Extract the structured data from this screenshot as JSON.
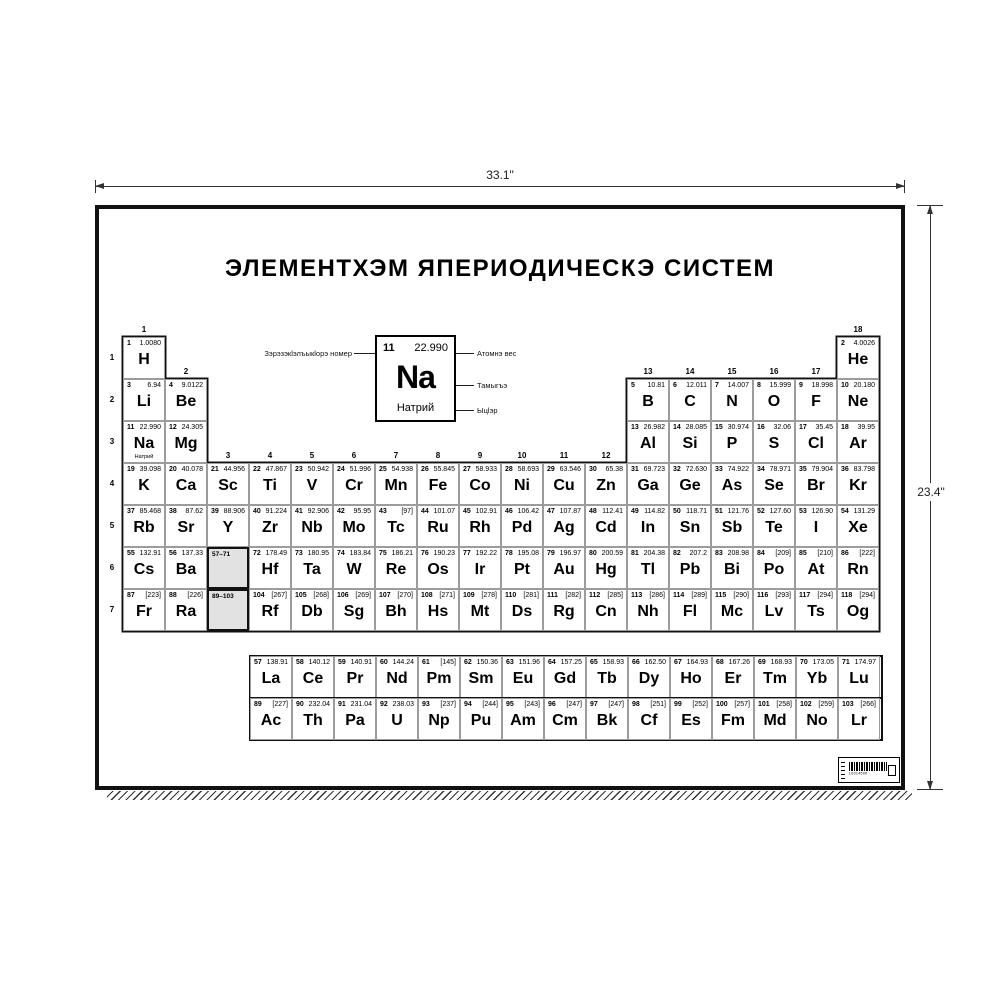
{
  "dimensions": {
    "width_label": "33.1\"",
    "height_label": "23.4\""
  },
  "poster": {
    "title": "ЭЛЕМЕНТХЭМ ЯПЕРИОДИЧЕСКЭ СИСТЕМ",
    "colors": {
      "ink": "#000000",
      "paper": "#ffffff",
      "placeholder_gray": "#e2e2e2",
      "grid_line": "#9c9c9c"
    }
  },
  "legend": {
    "number": "11",
    "mass": "22.990",
    "symbol": "Na",
    "name": "Натрий",
    "label_number": "Зэрэзэкlэлъыкlорэ номер",
    "label_mass": "Атомнэ вес",
    "label_symbol": "Тамыгъэ",
    "label_name": "Ыцlэр"
  },
  "table": {
    "group_labels": [
      "1",
      "2",
      "3",
      "4",
      "5",
      "6",
      "7",
      "8",
      "9",
      "10",
      "11",
      "12",
      "13",
      "14",
      "15",
      "16",
      "17",
      "18"
    ],
    "period_labels": [
      "1",
      "2",
      "3",
      "4",
      "5",
      "6",
      "7"
    ],
    "placeholders": [
      {
        "label": "57–71",
        "p": 6,
        "g": 3
      },
      {
        "label": "89–103",
        "p": 7,
        "g": 3
      }
    ],
    "elements": [
      {
        "p": 1,
        "g": 1,
        "n": "1",
        "sym": "H",
        "mass": "1.0080"
      },
      {
        "p": 1,
        "g": 18,
        "n": "2",
        "sym": "He",
        "mass": "4.0026"
      },
      {
        "p": 2,
        "g": 1,
        "n": "3",
        "sym": "Li",
        "mass": "6.94"
      },
      {
        "p": 2,
        "g": 2,
        "n": "4",
        "sym": "Be",
        "mass": "9.0122"
      },
      {
        "p": 2,
        "g": 13,
        "n": "5",
        "sym": "B",
        "mass": "10.81"
      },
      {
        "p": 2,
        "g": 14,
        "n": "6",
        "sym": "C",
        "mass": "12.011"
      },
      {
        "p": 2,
        "g": 15,
        "n": "7",
        "sym": "N",
        "mass": "14.007"
      },
      {
        "p": 2,
        "g": 16,
        "n": "8",
        "sym": "O",
        "mass": "15.999"
      },
      {
        "p": 2,
        "g": 17,
        "n": "9",
        "sym": "F",
        "mass": "18.998"
      },
      {
        "p": 2,
        "g": 18,
        "n": "10",
        "sym": "Ne",
        "mass": "20.180"
      },
      {
        "p": 3,
        "g": 1,
        "n": "11",
        "sym": "Na",
        "mass": "22.990",
        "name": "Натрий"
      },
      {
        "p": 3,
        "g": 2,
        "n": "12",
        "sym": "Mg",
        "mass": "24.305"
      },
      {
        "p": 3,
        "g": 13,
        "n": "13",
        "sym": "Al",
        "mass": "26.982"
      },
      {
        "p": 3,
        "g": 14,
        "n": "14",
        "sym": "Si",
        "mass": "28.085"
      },
      {
        "p": 3,
        "g": 15,
        "n": "15",
        "sym": "P",
        "mass": "30.974"
      },
      {
        "p": 3,
        "g": 16,
        "n": "16",
        "sym": "S",
        "mass": "32.06"
      },
      {
        "p": 3,
        "g": 17,
        "n": "17",
        "sym": "Cl",
        "mass": "35.45"
      },
      {
        "p": 3,
        "g": 18,
        "n": "18",
        "sym": "Ar",
        "mass": "39.95"
      },
      {
        "p": 4,
        "g": 1,
        "n": "19",
        "sym": "K",
        "mass": "39.098"
      },
      {
        "p": 4,
        "g": 2,
        "n": "20",
        "sym": "Ca",
        "mass": "40.078"
      },
      {
        "p": 4,
        "g": 3,
        "n": "21",
        "sym": "Sc",
        "mass": "44.956"
      },
      {
        "p": 4,
        "g": 4,
        "n": "22",
        "sym": "Ti",
        "mass": "47.867"
      },
      {
        "p": 4,
        "g": 5,
        "n": "23",
        "sym": "V",
        "mass": "50.942"
      },
      {
        "p": 4,
        "g": 6,
        "n": "24",
        "sym": "Cr",
        "mass": "51.996"
      },
      {
        "p": 4,
        "g": 7,
        "n": "25",
        "sym": "Mn",
        "mass": "54.938"
      },
      {
        "p": 4,
        "g": 8,
        "n": "26",
        "sym": "Fe",
        "mass": "55.845"
      },
      {
        "p": 4,
        "g": 9,
        "n": "27",
        "sym": "Co",
        "mass": "58.933"
      },
      {
        "p": 4,
        "g": 10,
        "n": "28",
        "sym": "Ni",
        "mass": "58.693"
      },
      {
        "p": 4,
        "g": 11,
        "n": "29",
        "sym": "Cu",
        "mass": "63.546"
      },
      {
        "p": 4,
        "g": 12,
        "n": "30",
        "sym": "Zn",
        "mass": "65.38"
      },
      {
        "p": 4,
        "g": 13,
        "n": "31",
        "sym": "Ga",
        "mass": "69.723"
      },
      {
        "p": 4,
        "g": 14,
        "n": "32",
        "sym": "Ge",
        "mass": "72.630"
      },
      {
        "p": 4,
        "g": 15,
        "n": "33",
        "sym": "As",
        "mass": "74.922"
      },
      {
        "p": 4,
        "g": 16,
        "n": "34",
        "sym": "Se",
        "mass": "78.971"
      },
      {
        "p": 4,
        "g": 17,
        "n": "35",
        "sym": "Br",
        "mass": "79.904"
      },
      {
        "p": 4,
        "g": 18,
        "n": "36",
        "sym": "Kr",
        "mass": "83.798"
      },
      {
        "p": 5,
        "g": 1,
        "n": "37",
        "sym": "Rb",
        "mass": "85.468"
      },
      {
        "p": 5,
        "g": 2,
        "n": "38",
        "sym": "Sr",
        "mass": "87.62"
      },
      {
        "p": 5,
        "g": 3,
        "n": "39",
        "sym": "Y",
        "mass": "88.906"
      },
      {
        "p": 5,
        "g": 4,
        "n": "40",
        "sym": "Zr",
        "mass": "91.224"
      },
      {
        "p": 5,
        "g": 5,
        "n": "41",
        "sym": "Nb",
        "mass": "92.906"
      },
      {
        "p": 5,
        "g": 6,
        "n": "42",
        "sym": "Mo",
        "mass": "95.95"
      },
      {
        "p": 5,
        "g": 7,
        "n": "43",
        "sym": "Tc",
        "mass": "[97]"
      },
      {
        "p": 5,
        "g": 8,
        "n": "44",
        "sym": "Ru",
        "mass": "101.07"
      },
      {
        "p": 5,
        "g": 9,
        "n": "45",
        "sym": "Rh",
        "mass": "102.91"
      },
      {
        "p": 5,
        "g": 10,
        "n": "46",
        "sym": "Pd",
        "mass": "106.42"
      },
      {
        "p": 5,
        "g": 11,
        "n": "47",
        "sym": "Ag",
        "mass": "107.87"
      },
      {
        "p": 5,
        "g": 12,
        "n": "48",
        "sym": "Cd",
        "mass": "112.41"
      },
      {
        "p": 5,
        "g": 13,
        "n": "49",
        "sym": "In",
        "mass": "114.82"
      },
      {
        "p": 5,
        "g": 14,
        "n": "50",
        "sym": "Sn",
        "mass": "118.71"
      },
      {
        "p": 5,
        "g": 15,
        "n": "51",
        "sym": "Sb",
        "mass": "121.76"
      },
      {
        "p": 5,
        "g": 16,
        "n": "52",
        "sym": "Te",
        "mass": "127.60"
      },
      {
        "p": 5,
        "g": 17,
        "n": "53",
        "sym": "I",
        "mass": "126.90"
      },
      {
        "p": 5,
        "g": 18,
        "n": "54",
        "sym": "Xe",
        "mass": "131.29"
      },
      {
        "p": 6,
        "g": 1,
        "n": "55",
        "sym": "Cs",
        "mass": "132.91"
      },
      {
        "p": 6,
        "g": 2,
        "n": "56",
        "sym": "Ba",
        "mass": "137.33"
      },
      {
        "p": 6,
        "g": 4,
        "n": "72",
        "sym": "Hf",
        "mass": "178.49"
      },
      {
        "p": 6,
        "g": 5,
        "n": "73",
        "sym": "Ta",
        "mass": "180.95"
      },
      {
        "p": 6,
        "g": 6,
        "n": "74",
        "sym": "W",
        "mass": "183.84"
      },
      {
        "p": 6,
        "g": 7,
        "n": "75",
        "sym": "Re",
        "mass": "186.21"
      },
      {
        "p": 6,
        "g": 8,
        "n": "76",
        "sym": "Os",
        "mass": "190.23"
      },
      {
        "p": 6,
        "g": 9,
        "n": "77",
        "sym": "Ir",
        "mass": "192.22"
      },
      {
        "p": 6,
        "g": 10,
        "n": "78",
        "sym": "Pt",
        "mass": "195.08"
      },
      {
        "p": 6,
        "g": 11,
        "n": "79",
        "sym": "Au",
        "mass": "196.97"
      },
      {
        "p": 6,
        "g": 12,
        "n": "80",
        "sym": "Hg",
        "mass": "200.59"
      },
      {
        "p": 6,
        "g": 13,
        "n": "81",
        "sym": "Tl",
        "mass": "204.38"
      },
      {
        "p": 6,
        "g": 14,
        "n": "82",
        "sym": "Pb",
        "mass": "207.2"
      },
      {
        "p": 6,
        "g": 15,
        "n": "83",
        "sym": "Bi",
        "mass": "208.98"
      },
      {
        "p": 6,
        "g": 16,
        "n": "84",
        "sym": "Po",
        "mass": "[209]"
      },
      {
        "p": 6,
        "g": 17,
        "n": "85",
        "sym": "At",
        "mass": "[210]"
      },
      {
        "p": 6,
        "g": 18,
        "n": "86",
        "sym": "Rn",
        "mass": "[222]"
      },
      {
        "p": 7,
        "g": 1,
        "n": "87",
        "sym": "Fr",
        "mass": "[223]"
      },
      {
        "p": 7,
        "g": 2,
        "n": "88",
        "sym": "Ra",
        "mass": "[226]"
      },
      {
        "p": 7,
        "g": 4,
        "n": "104",
        "sym": "Rf",
        "mass": "[267]"
      },
      {
        "p": 7,
        "g": 5,
        "n": "105",
        "sym": "Db",
        "mass": "[268]"
      },
      {
        "p": 7,
        "g": 6,
        "n": "106",
        "sym": "Sg",
        "mass": "[269]"
      },
      {
        "p": 7,
        "g": 7,
        "n": "107",
        "sym": "Bh",
        "mass": "[270]"
      },
      {
        "p": 7,
        "g": 8,
        "n": "108",
        "sym": "Hs",
        "mass": "[271]"
      },
      {
        "p": 7,
        "g": 9,
        "n": "109",
        "sym": "Mt",
        "mass": "[278]"
      },
      {
        "p": 7,
        "g": 10,
        "n": "110",
        "sym": "Ds",
        "mass": "[281]"
      },
      {
        "p": 7,
        "g": 11,
        "n": "111",
        "sym": "Rg",
        "mass": "[282]"
      },
      {
        "p": 7,
        "g": 12,
        "n": "112",
        "sym": "Cn",
        "mass": "[285]"
      },
      {
        "p": 7,
        "g": 13,
        "n": "113",
        "sym": "Nh",
        "mass": "[286]"
      },
      {
        "p": 7,
        "g": 14,
        "n": "114",
        "sym": "Fl",
        "mass": "[289]"
      },
      {
        "p": 7,
        "g": 15,
        "n": "115",
        "sym": "Mc",
        "mass": "[290]"
      },
      {
        "p": 7,
        "g": 16,
        "n": "116",
        "sym": "Lv",
        "mass": "[293]"
      },
      {
        "p": 7,
        "g": 17,
        "n": "117",
        "sym": "Ts",
        "mass": "[294]"
      },
      {
        "p": 7,
        "g": 18,
        "n": "118",
        "sym": "Og",
        "mass": "[294]"
      }
    ]
  },
  "fblock": {
    "lanthanides": [
      {
        "n": "57",
        "sym": "La",
        "mass": "138.91"
      },
      {
        "n": "58",
        "sym": "Ce",
        "mass": "140.12"
      },
      {
        "n": "59",
        "sym": "Pr",
        "mass": "140.91"
      },
      {
        "n": "60",
        "sym": "Nd",
        "mass": "144.24"
      },
      {
        "n": "61",
        "sym": "Pm",
        "mass": "[145]"
      },
      {
        "n": "62",
        "sym": "Sm",
        "mass": "150.36"
      },
      {
        "n": "63",
        "sym": "Eu",
        "mass": "151.96"
      },
      {
        "n": "64",
        "sym": "Gd",
        "mass": "157.25"
      },
      {
        "n": "65",
        "sym": "Tb",
        "mass": "158.93"
      },
      {
        "n": "66",
        "sym": "Dy",
        "mass": "162.50"
      },
      {
        "n": "67",
        "sym": "Ho",
        "mass": "164.93"
      },
      {
        "n": "68",
        "sym": "Er",
        "mass": "167.26"
      },
      {
        "n": "69",
        "sym": "Tm",
        "mass": "168.93"
      },
      {
        "n": "70",
        "sym": "Yb",
        "mass": "173.05"
      },
      {
        "n": "71",
        "sym": "Lu",
        "mass": "174.97"
      }
    ],
    "actinides": [
      {
        "n": "89",
        "sym": "Ac",
        "mass": "[227]"
      },
      {
        "n": "90",
        "sym": "Th",
        "mass": "232.04"
      },
      {
        "n": "91",
        "sym": "Pa",
        "mass": "231.04"
      },
      {
        "n": "92",
        "sym": "U",
        "mass": "238.03"
      },
      {
        "n": "93",
        "sym": "Np",
        "mass": "[237]"
      },
      {
        "n": "94",
        "sym": "Pu",
        "mass": "[244]"
      },
      {
        "n": "95",
        "sym": "Am",
        "mass": "[243]"
      },
      {
        "n": "96",
        "sym": "Cm",
        "mass": "[247]"
      },
      {
        "n": "97",
        "sym": "Bk",
        "mass": "[247]"
      },
      {
        "n": "98",
        "sym": "Cf",
        "mass": "[251]"
      },
      {
        "n": "99",
        "sym": "Es",
        "mass": "[252]"
      },
      {
        "n": "100",
        "sym": "Fm",
        "mass": "[257]"
      },
      {
        "n": "101",
        "sym": "Md",
        "mass": "[258]"
      },
      {
        "n": "102",
        "sym": "No",
        "mass": "[259]"
      },
      {
        "n": "103",
        "sym": "Lr",
        "mass": "[266]"
      }
    ]
  },
  "barcode": {
    "text": "L0014500"
  }
}
